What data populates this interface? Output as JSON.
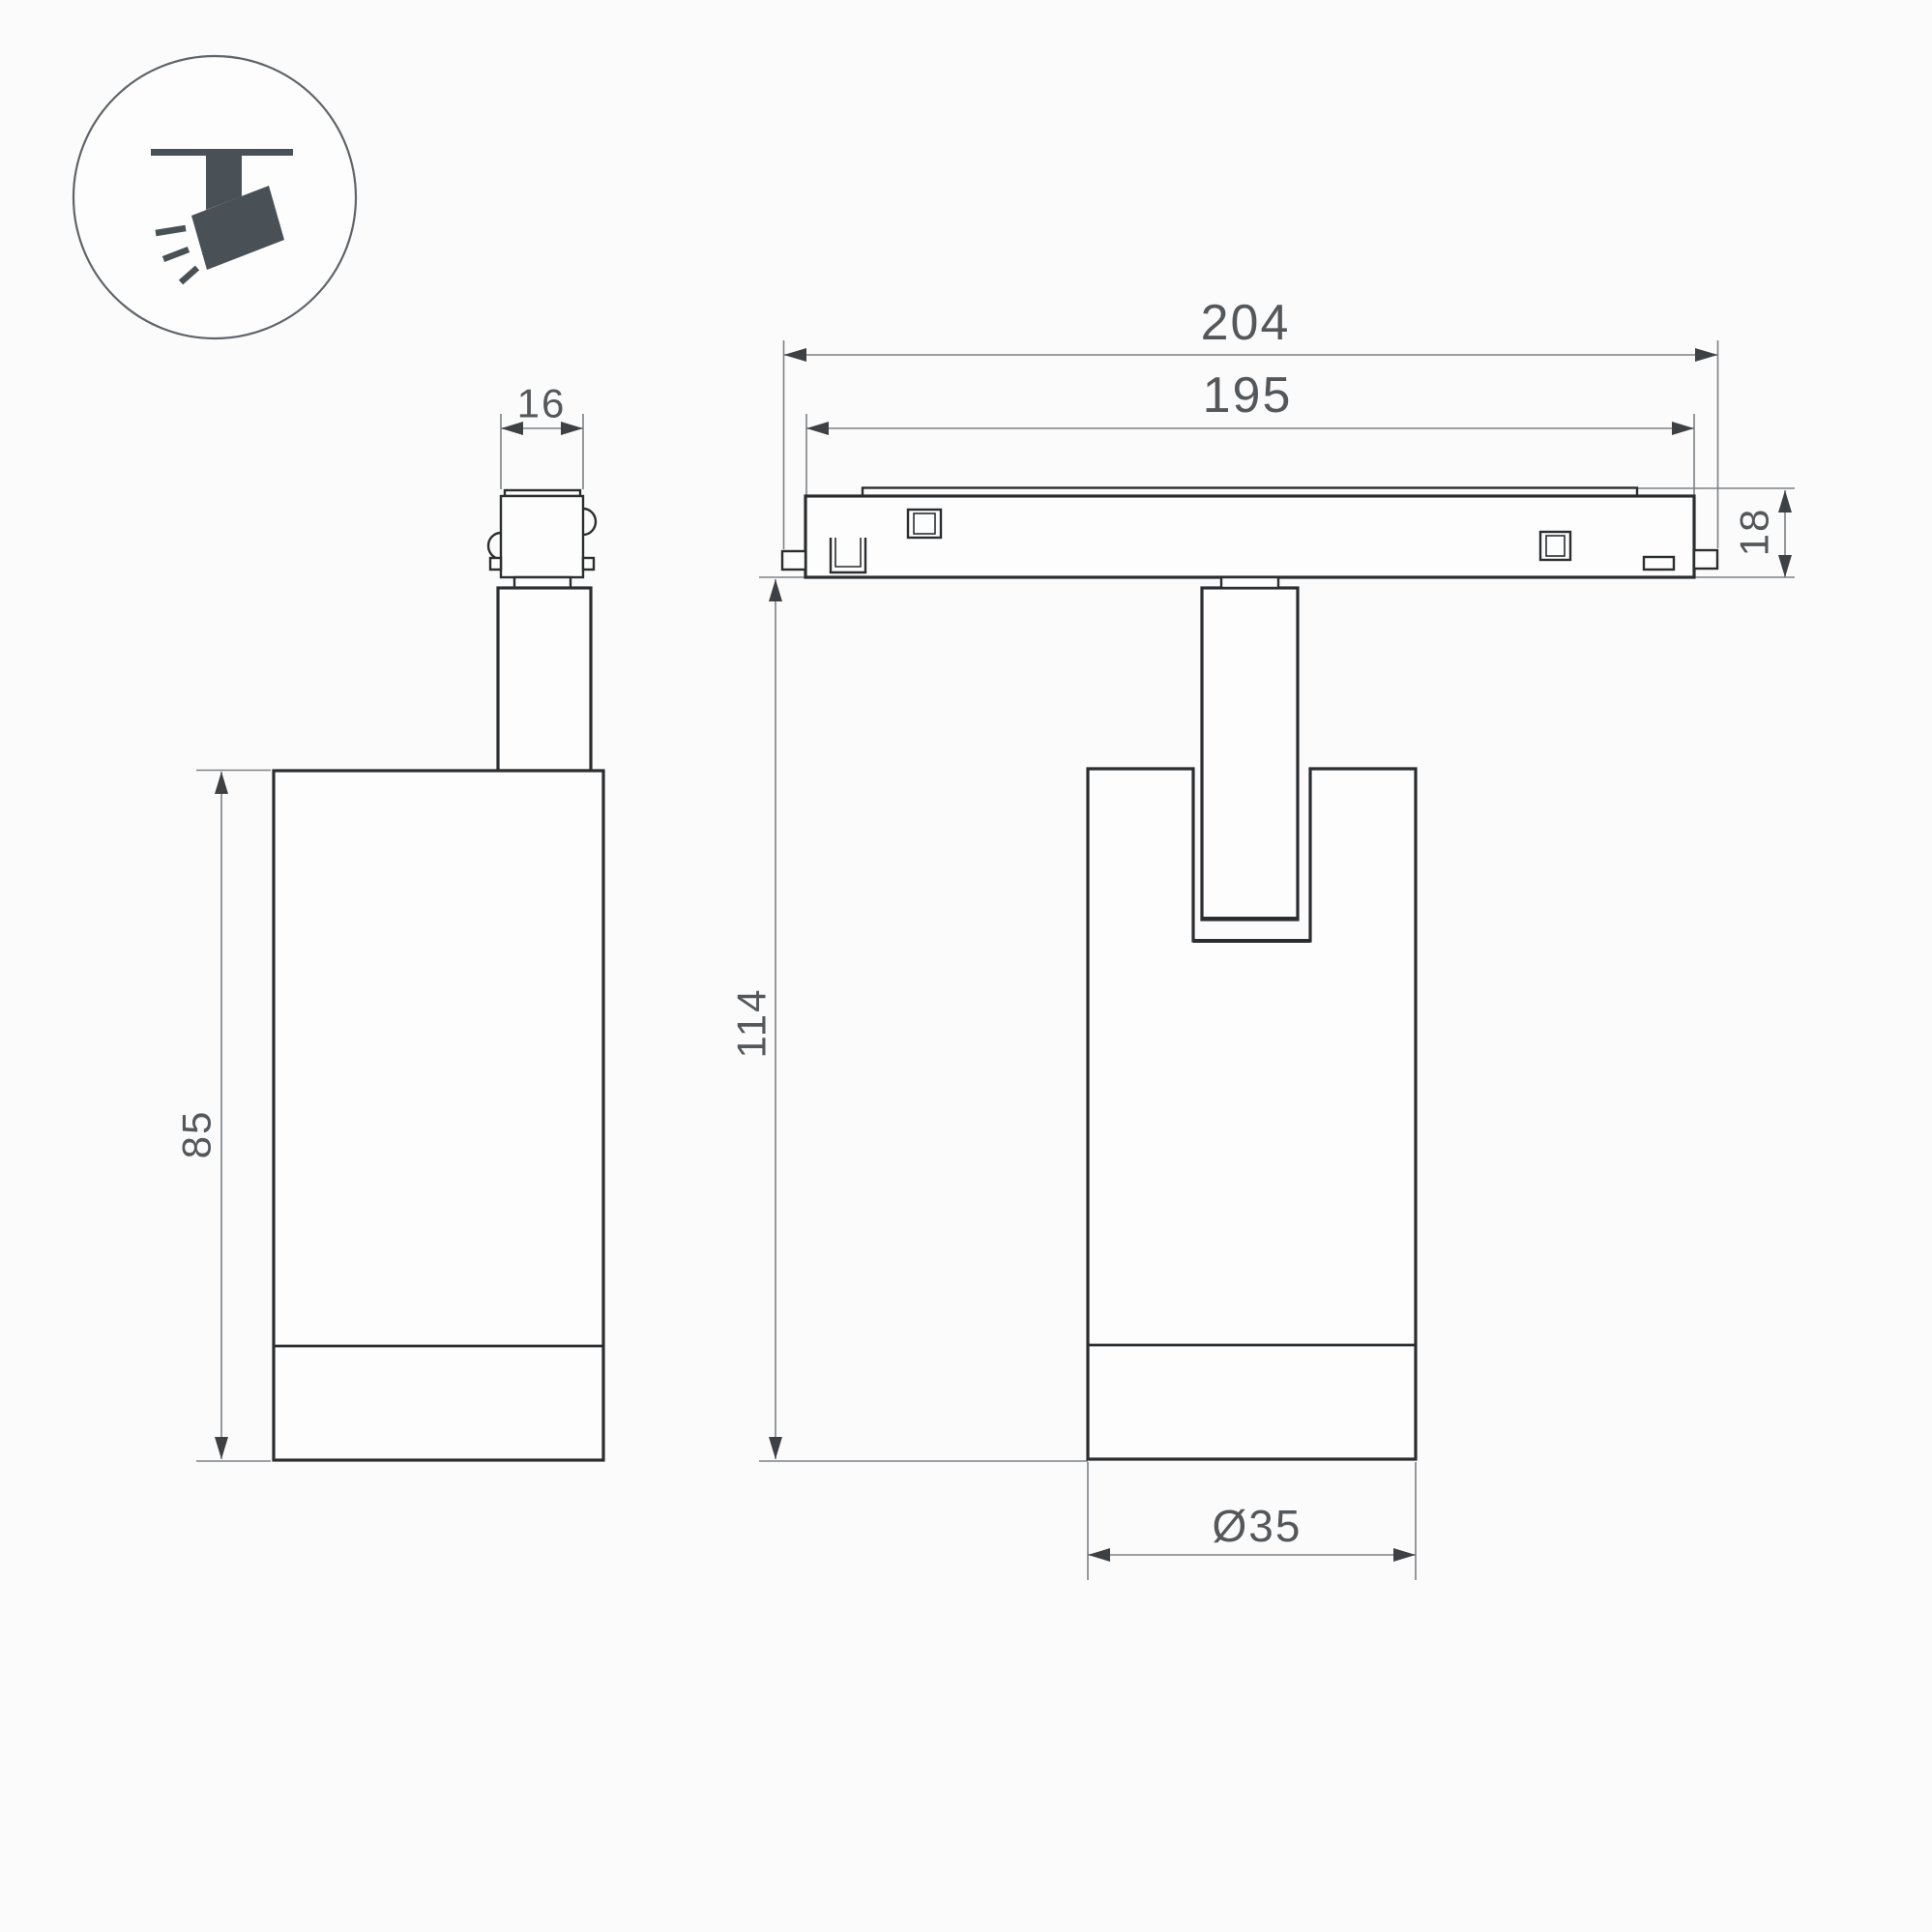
{
  "colors": {
    "background": "#fbfbfc",
    "object_line": "#2b2d2e",
    "dimension_line": "#7d8184",
    "arrow": "#3e4144",
    "text": "#54585a",
    "icon": "#4a5156"
  },
  "icon": {
    "name": "track-spotlight-icon"
  },
  "views": {
    "side_view": {
      "dims": {
        "connector_width": "16",
        "body_height": "85"
      }
    },
    "front_view": {
      "dims": {
        "track_length": "204",
        "track_inner_length": "195",
        "track_height": "18",
        "total_height": "114",
        "body_diameter": "Ø35"
      }
    }
  }
}
